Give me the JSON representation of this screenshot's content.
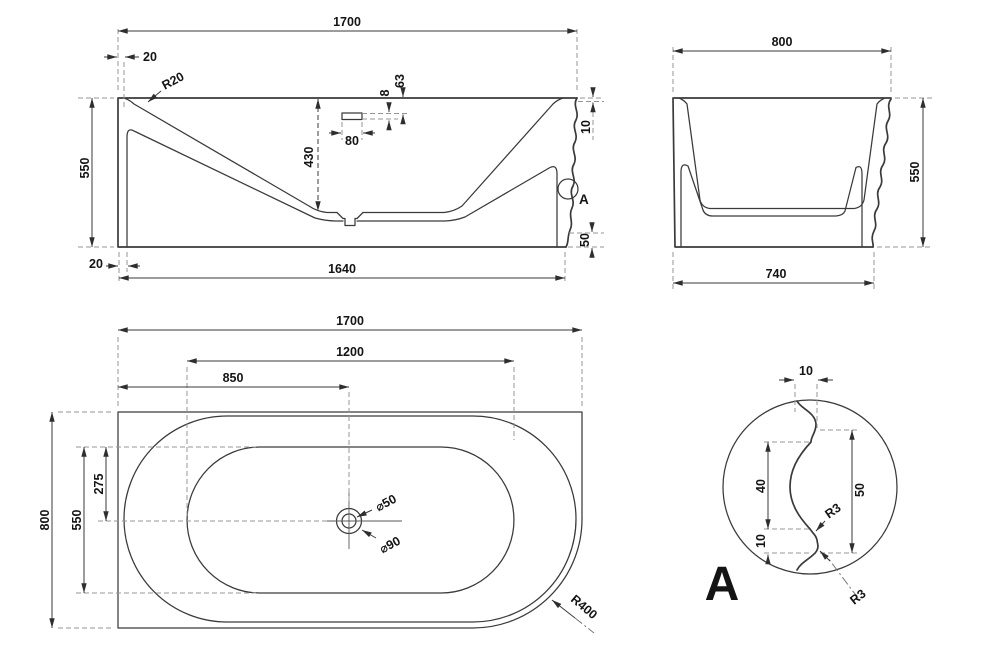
{
  "drawing": {
    "front": {
      "w_top": "1700",
      "rim_offset": "20",
      "corner_radius": "R20",
      "overflow_height": "8",
      "overflow_depth": "63",
      "overflow_width": "80",
      "inner_depth": "430",
      "height": "550",
      "bottom_offset": "20",
      "w_bottom": "1640",
      "ripple_offset": "10",
      "plinth_height": "50",
      "detail_ref": "A"
    },
    "side": {
      "w_top": "800",
      "height": "550",
      "w_bottom": "740"
    },
    "plan": {
      "w_top": "1700",
      "basin_length": "1200",
      "drain_from_left": "850",
      "depth": "800",
      "basin_width": "550",
      "drain_from_back": "275",
      "drain_inner_dia": "⌀50",
      "drain_outer_dia": "⌀90",
      "corner_radius": "R400"
    },
    "detail": {
      "label": "A",
      "offset_top": "10",
      "upper_height": "40",
      "lower_height": "10",
      "total_height": "50",
      "fillet_radius_1": "R3",
      "fillet_radius_2": "R3"
    }
  }
}
